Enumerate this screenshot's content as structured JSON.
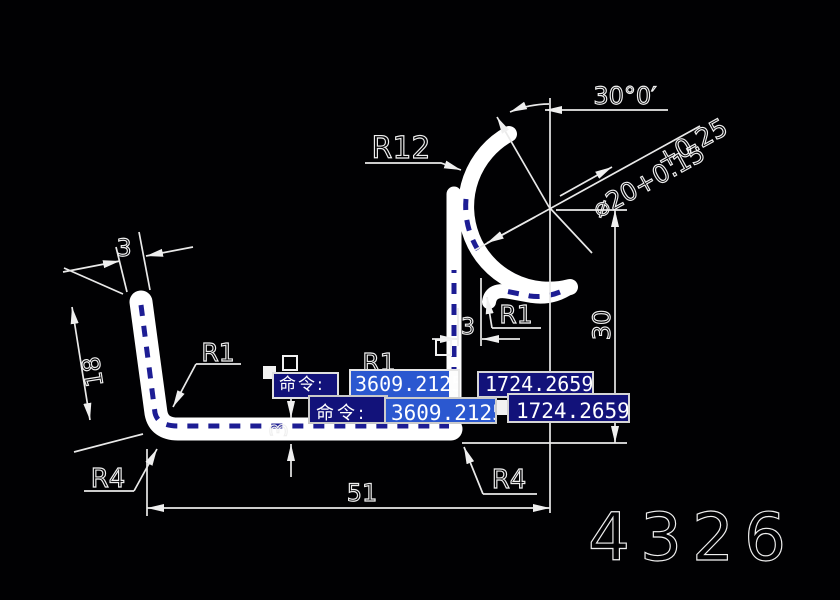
{
  "colors": {
    "background": "#010103",
    "line_color": "#ffffff",
    "selection_dash": "#1d1d94",
    "command_box_bg": "#12127a",
    "highlight_bg": "#2b58d0"
  },
  "drawing": {
    "labels": {
      "r12": "R12",
      "r1_left": "R1",
      "r1_center": "R1",
      "r1_right": "R1",
      "r4_left": "R4",
      "r4_right": "R4",
      "dim_3_top": "3",
      "dim_18": "18",
      "dim_3_bottom": "3",
      "dim_3_gap": "3",
      "dim_51": "51",
      "dim_30": "30",
      "angle": "30°0′",
      "tol_upper": "+0.25",
      "dia_lower": "⌀20+0.15"
    },
    "part_number": "4326"
  },
  "command_overlay": {
    "rows": [
      {
        "prompt": "命令:",
        "x": "3609.2125",
        "y": "1724.2659"
      },
      {
        "prompt": "命令:",
        "x": "3609.2125",
        "y": "1724.2659"
      }
    ]
  }
}
